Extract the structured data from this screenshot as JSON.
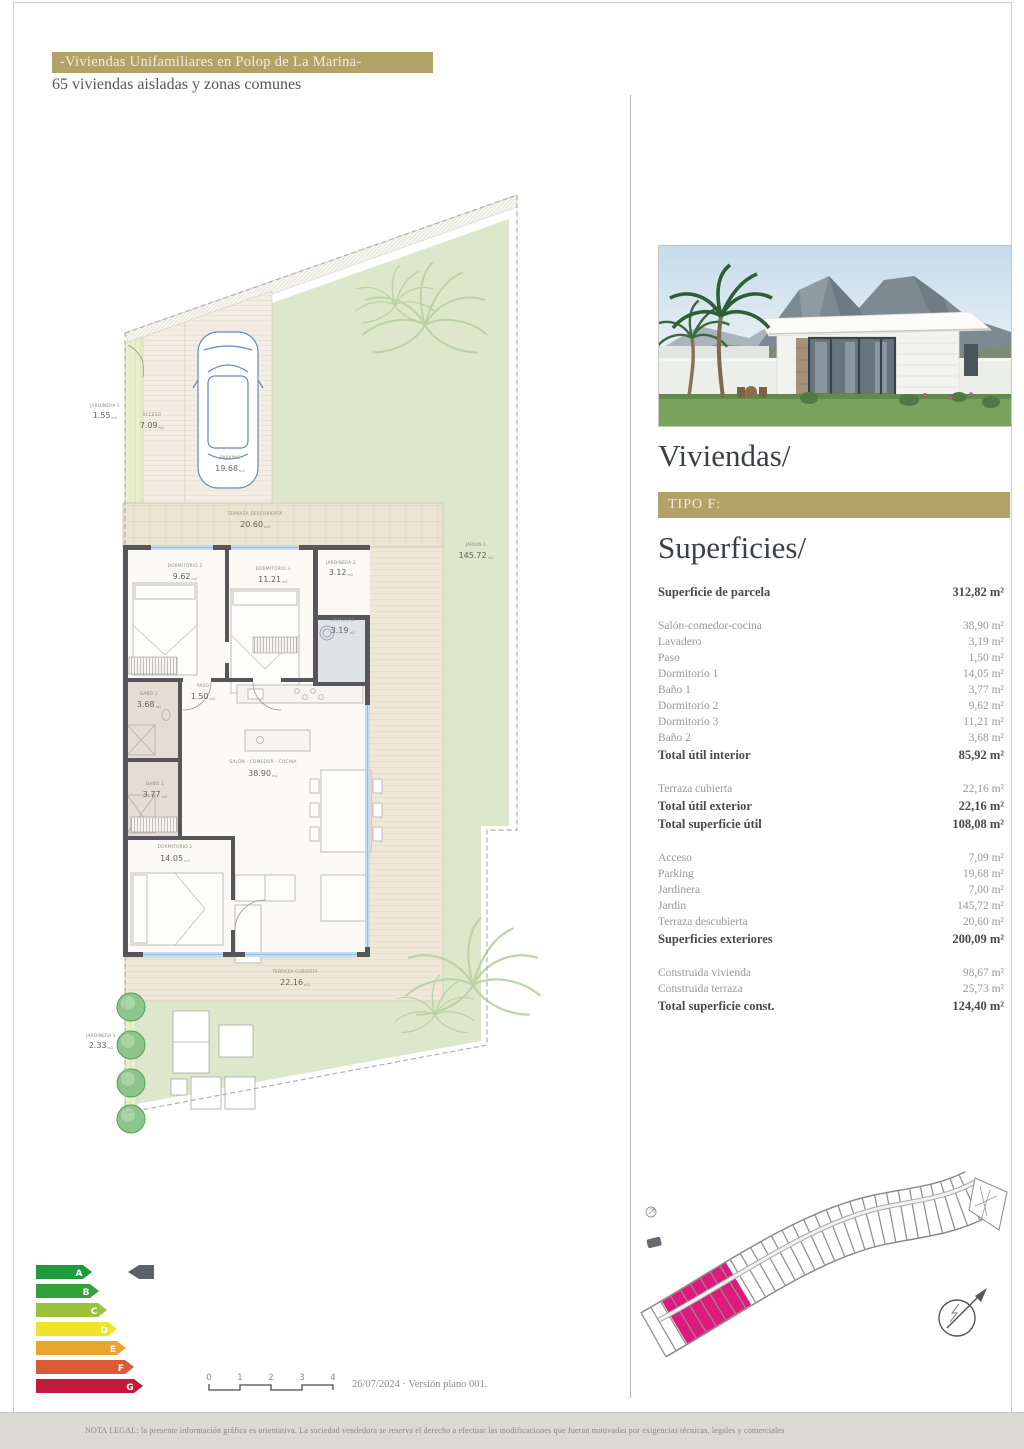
{
  "page": {
    "header_bar": "-Viviendas Unifamiliares en Polop de La Marina-",
    "subtitle": "65 viviendas aisladas y zonas comunes",
    "version_note": "26/07/2024 · Versión plano 001.",
    "legal_note": "NOTA LEGAL: la presente información gráfica es orientativa. La sociedad vendedora se reserva el derecho a efectuar las modificaciones que fueran motivadas por exigencias técnicas, legales y comerciales",
    "colors": {
      "gold": "#b2a268",
      "highlight_pink": "#e0197d",
      "plan_green": "#dde7cc",
      "terrace_beige": "#efe8d8"
    }
  },
  "sidebar": {
    "title": "Viviendas/",
    "type_label": "TIPO F:",
    "section_title": "Superficies/",
    "surface_groups": [
      {
        "rows": [
          {
            "label": "Superficie de parcela",
            "value": "312,82 m²",
            "strong": true
          }
        ]
      },
      {
        "rows": [
          {
            "label": "Salón-comedor-cocina",
            "value": "38,90 m²",
            "strong": false
          },
          {
            "label": "Lavadero",
            "value": "3,19 m²",
            "strong": false
          },
          {
            "label": "Paso",
            "value": "1,50 m²",
            "strong": false
          },
          {
            "label": "Dormitorio 1",
            "value": "14,05 m²",
            "strong": false
          },
          {
            "label": "Baño 1",
            "value": "3,77 m²",
            "strong": false
          },
          {
            "label": "Dormitorio 2",
            "value": "9,62 m²",
            "strong": false
          },
          {
            "label": "Dormitorio 3",
            "value": "11,21 m²",
            "strong": false
          },
          {
            "label": "Baño 2",
            "value": "3,68 m²",
            "strong": false
          },
          {
            "label": "Total útil interior",
            "value": "85,92 m²",
            "strong": true
          }
        ]
      },
      {
        "rows": [
          {
            "label": "Terraza cubierta",
            "value": "22,16 m²",
            "strong": false
          },
          {
            "label": "Total útil exterior",
            "value": "22,16 m²",
            "strong": true
          },
          {
            "label": "Total superficie útil",
            "value": "108,08 m²",
            "strong": true
          }
        ]
      },
      {
        "rows": [
          {
            "label": "Acceso",
            "value": "7,09 m²",
            "strong": false
          },
          {
            "label": "Parking",
            "value": "19,68 m²",
            "strong": false
          },
          {
            "label": "Jardinera",
            "value": "7,00 m²",
            "strong": false
          },
          {
            "label": "Jardin",
            "value": "145,72 m²",
            "strong": false
          },
          {
            "label": "Terraza descubierta",
            "value": "20,60 m²",
            "strong": false
          },
          {
            "label": "Superficies exteriores",
            "value": "200,09 m²",
            "strong": true
          }
        ]
      },
      {
        "rows": [
          {
            "label": "Construida vivienda",
            "value": "98,67 m²",
            "strong": false
          },
          {
            "label": "Construida terraza",
            "value": "25,73 m²",
            "strong": false
          },
          {
            "label": "Total superficie const.",
            "value": "124,40 m²",
            "strong": true
          }
        ]
      }
    ]
  },
  "plan": {
    "unit": "m2",
    "labels": [
      {
        "name": "JARDINERA 1",
        "area": "1.55"
      },
      {
        "name": "ACCESO",
        "area": "7.09"
      },
      {
        "name": "PARKING",
        "area": "19.68"
      },
      {
        "name": "JARDIN 1",
        "area": "145.72"
      },
      {
        "name": "TERRAZA DESCUBIERTA",
        "area": "20.60"
      },
      {
        "name": "JARDINERA 2",
        "area": "3.12"
      },
      {
        "name": "DORMITORIO 2",
        "area": "9.62"
      },
      {
        "name": "DORMITORIO 3",
        "area": "11.21"
      },
      {
        "name": "LAVADERO",
        "area": "3.19"
      },
      {
        "name": "PASO",
        "area": "1.50"
      },
      {
        "name": "BAÑO 2",
        "area": "3.68"
      },
      {
        "name": "BAÑO 1",
        "area": "3.77"
      },
      {
        "name": "SALÓN - COMEDOR - COCINA",
        "area": "38.90"
      },
      {
        "name": "DORMITORIO 1",
        "area": "14.05"
      },
      {
        "name": "TERRAZA CUBIERTA",
        "area": "22.16"
      },
      {
        "name": "JARDINERA 3",
        "area": "2.33"
      }
    ]
  },
  "energy": {
    "selected": "A",
    "ratings": [
      {
        "letter": "A",
        "color": "#21993f"
      },
      {
        "letter": "B",
        "color": "#33a03c"
      },
      {
        "letter": "C",
        "color": "#9cc23b"
      },
      {
        "letter": "D",
        "color": "#f0e32b"
      },
      {
        "letter": "E",
        "color": "#e9a52d"
      },
      {
        "letter": "F",
        "color": "#d95b33"
      },
      {
        "letter": "G",
        "color": "#c41a3b"
      }
    ]
  },
  "scale_bar": {
    "ticks": [
      "0",
      "1",
      "2",
      "3",
      "4"
    ]
  }
}
